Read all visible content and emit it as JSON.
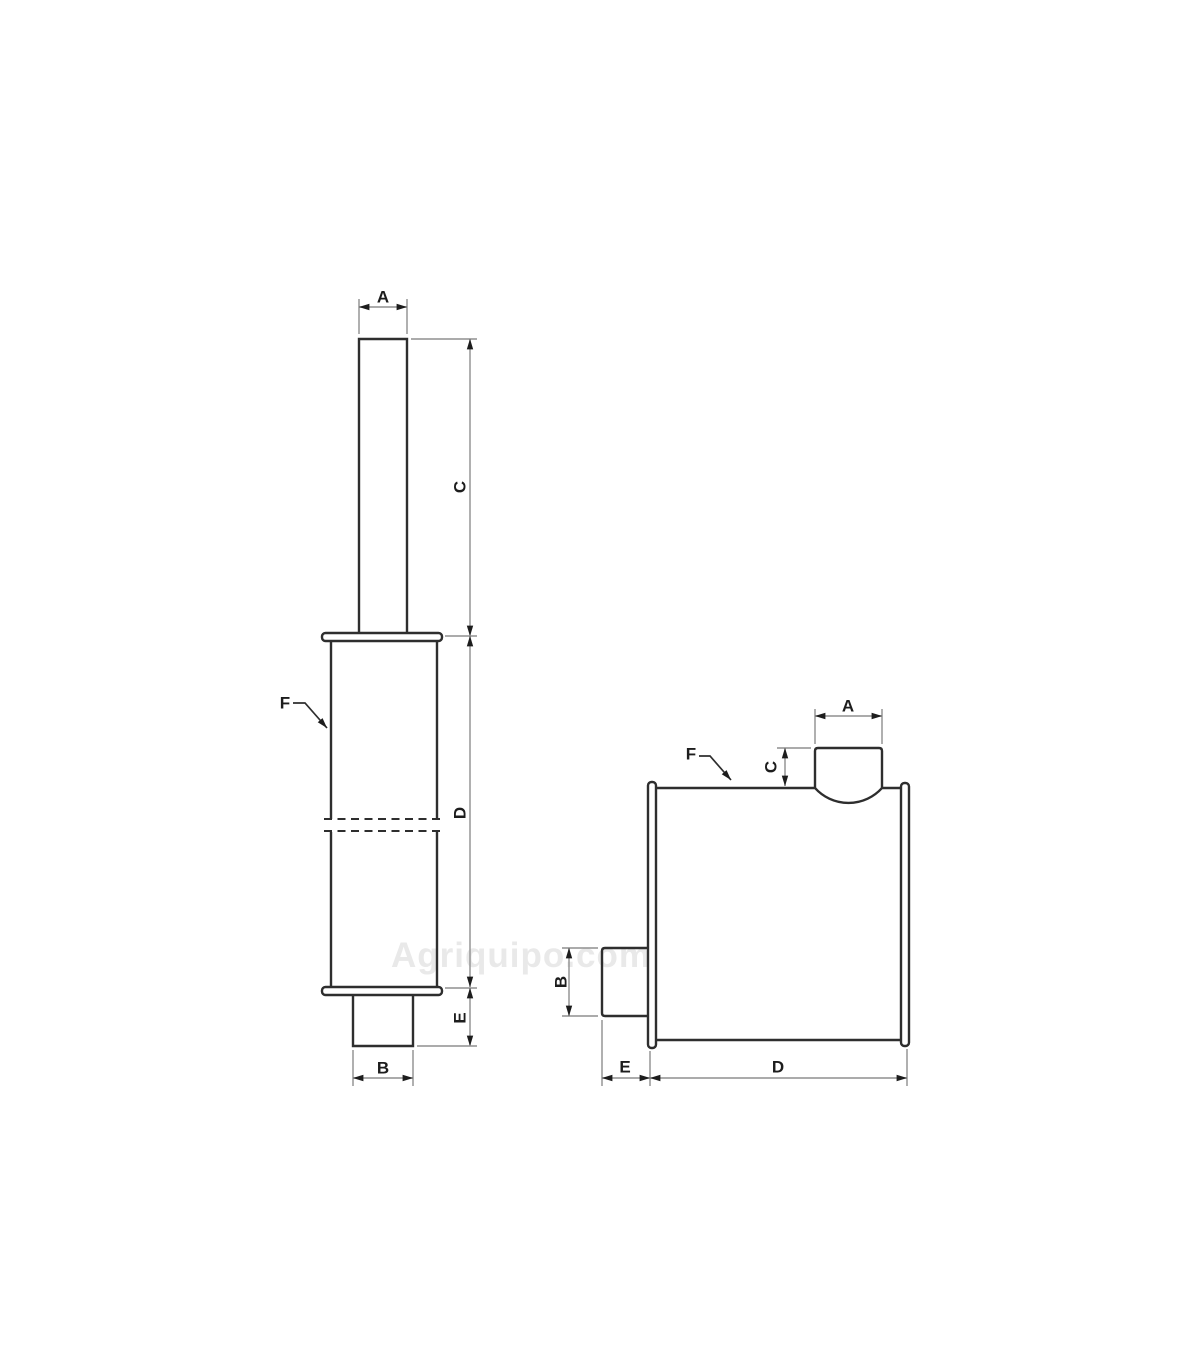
{
  "watermark": {
    "text": "Agriquipo.com"
  },
  "colors": {
    "outline": "#2e2e2e",
    "dimension_lines": "#8f8f8f",
    "arrowheads": "#1d1d1d",
    "labels": "#1d1d1d",
    "watermark": "#e9e9e9",
    "background": "#ffffff"
  },
  "views": {
    "front_vertical": {
      "dim_a": "A",
      "dim_b": "B",
      "dim_c": "C",
      "dim_d": "D",
      "dim_e": "E",
      "ref_f": "F"
    },
    "side_horizontal": {
      "dim_a": "A",
      "dim_b": "B",
      "dim_c": "C",
      "dim_d": "D",
      "dim_e": "E",
      "ref_f": "F"
    }
  }
}
